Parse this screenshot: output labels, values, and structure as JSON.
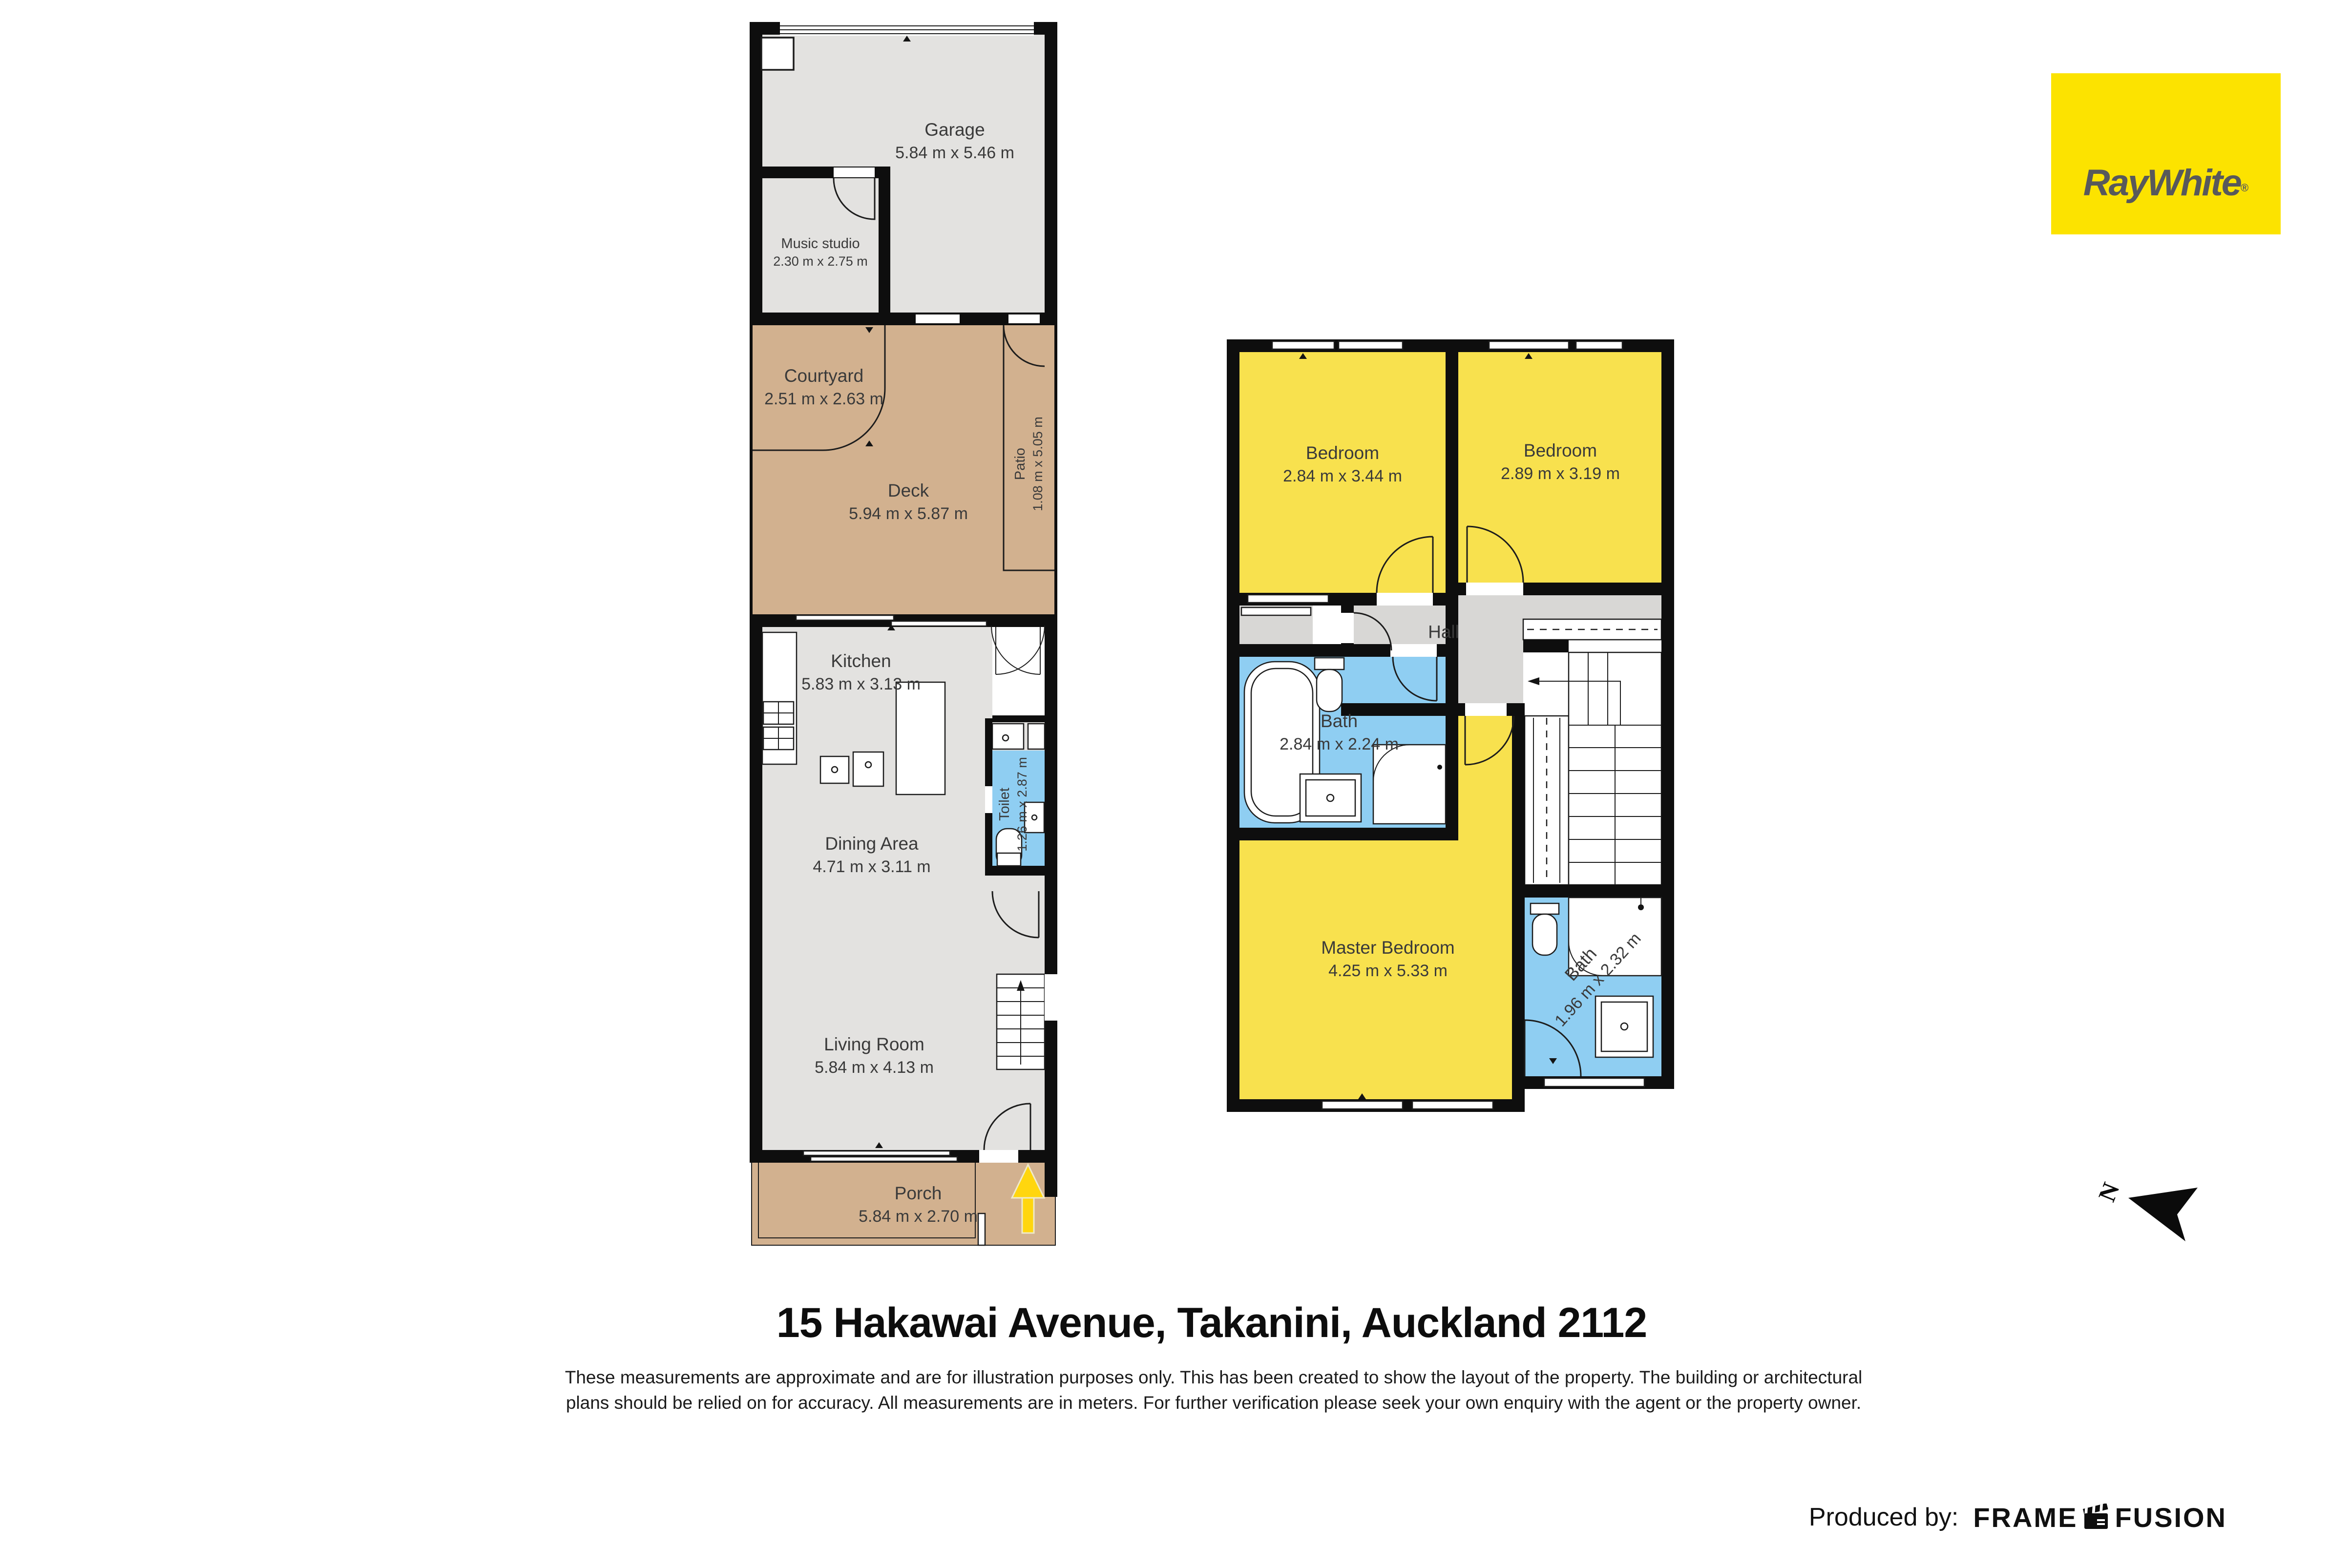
{
  "branding": {
    "logo_text": "RayWhite",
    "registered_mark": "®"
  },
  "title": "15 Hakawai Avenue, Takanini, Auckland 2112",
  "disclaimer": {
    "line1": "These measurements are approximate and are for illustration purposes only. This has been created to show the layout of the property. The building or architectural",
    "line2": "plans should be relied on for accuracy. All measurements are in meters. For further verification please seek your own enquiry with the agent or the property owner."
  },
  "compass": {
    "north_label": "N"
  },
  "footer": {
    "produced_by_label": "Produced by:",
    "producer_word1": "FRAME",
    "producer_word2": "FUSION"
  },
  "floors": {
    "ground": {
      "rooms": [
        {
          "name": "Garage",
          "dims": "5.84 m x 5.46 m"
        },
        {
          "name": "Music studio",
          "dims": "2.30 m x 2.75 m"
        },
        {
          "name": "Courtyard",
          "dims": "2.51 m x 2.63 m"
        },
        {
          "name": "Deck",
          "dims": "5.94 m x 5.87 m"
        },
        {
          "name": "Patio",
          "dims": "1.08 m x 5.05 m"
        },
        {
          "name": "Kitchen",
          "dims": "5.83 m x 3.13 m"
        },
        {
          "name": "Dining Area",
          "dims": "4.71 m x 3.11 m"
        },
        {
          "name": "Toilet",
          "dims": "1.26 m x 2.87 m"
        },
        {
          "name": "Living Room",
          "dims": "5.84 m x 4.13 m"
        },
        {
          "name": "Porch",
          "dims": "5.84 m x 2.70 m"
        }
      ]
    },
    "upper": {
      "rooms": [
        {
          "name": "Bedroom",
          "dims": "2.84 m x 3.44 m"
        },
        {
          "name": "Bedroom",
          "dims": "2.89 m x 3.19 m"
        },
        {
          "name": "Hall",
          "dims": ""
        },
        {
          "name": "Bath",
          "dims": "2.84 m x 2.24 m"
        },
        {
          "name": "Master Bedroom",
          "dims": "4.25 m x 5.33 m"
        },
        {
          "name": "Bath",
          "dims": "1.96 m x 2.32 m"
        }
      ]
    }
  },
  "colors": {
    "wall": "#0e0e0e",
    "room-gray": "#e3e2e0",
    "hall-gray": "#d8d7d5",
    "yellow": "#f8e14e",
    "blue": "#8fcef2",
    "tan": "#d2b18f",
    "arrow-yellow": "#ffd60e",
    "brand-yellow": "#fce300",
    "brand-text": "#58595b",
    "label-ink": "#3a3a3a"
  }
}
